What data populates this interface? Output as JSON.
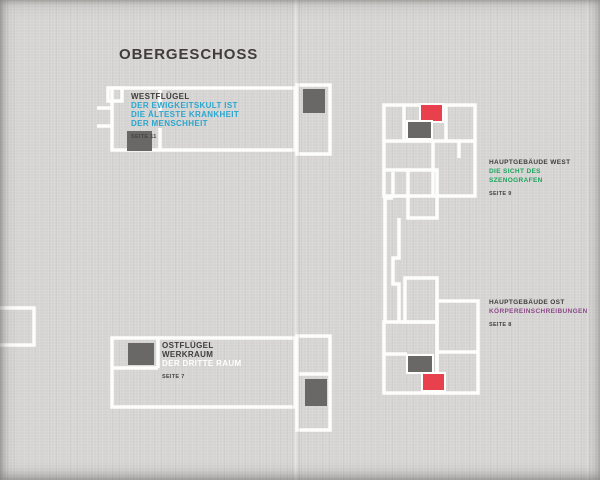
{
  "page_title": "OBERGESCHOSS",
  "colors": {
    "background": "#d6d5d3",
    "wall_white": "#fdfdfc",
    "room_dark_gray": "#6a6866",
    "room_red": "#e8404d",
    "heading_dark": "#403d3a",
    "subtitle_cyan": "#2aa6cf",
    "subtitle_green": "#1ea45c",
    "subtitle_purple": "#8c4a89",
    "subtitle_white": "#ffffff"
  },
  "sections": [
    {
      "id": "westfluegel",
      "title_lines": [
        "WESTFLÜGEL"
      ],
      "subtitle_lines": [
        "DER EWIGKEITSKULT IST",
        "DIE ÄLTESTE KRANKHEIT",
        "DER MENSCHHEIT"
      ],
      "subtitle_color": "#2aa6cf",
      "page_ref": "SEITE 11"
    },
    {
      "id": "hauptgebaeude-west",
      "title_lines": [
        "HAUPTGEBÄUDE WEST"
      ],
      "subtitle_lines": [
        "DIE SICHT DES",
        "SZENOGRAFEN"
      ],
      "subtitle_color": "#1ea45c",
      "page_ref": "SEITE 9"
    },
    {
      "id": "hauptgebaeude-ost",
      "title_lines": [
        "HAUPTGEBÄUDE OST"
      ],
      "subtitle_lines": [
        "KÖRPEREINSCHREIBUNGEN"
      ],
      "subtitle_color": "#8c4a89",
      "page_ref": "SEITE 8"
    },
    {
      "id": "ostfluegel",
      "title_lines": [
        "OSTFLÜGEL",
        "WERKRAUM"
      ],
      "subtitle_lines": [
        "DER DRITTE RAUM"
      ],
      "subtitle_color": "#ffffff",
      "page_ref": "SEITE 7"
    }
  ]
}
